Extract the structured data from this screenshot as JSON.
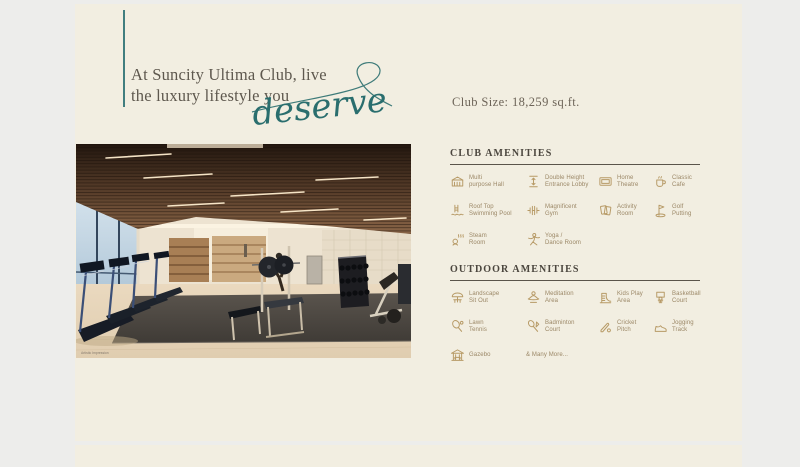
{
  "hero": {
    "line1": "At Suncity Ultima Club, live",
    "line2": "the luxury lifestyle you",
    "script": "deserve"
  },
  "club_size": {
    "label": "Club Size: 18,259 sq.ft."
  },
  "photo": {
    "caption": "Artistic Impression"
  },
  "club_amenities": {
    "title": "CLUB AMENITIES",
    "items": [
      {
        "icon": "hall-icon",
        "label": "Multi purpose Hall",
        "lines": [
          "Multi",
          "purpose Hall"
        ]
      },
      {
        "icon": "lobby-icon",
        "label": "Double Height Entrance Lobby",
        "lines": [
          "Double Height",
          "Entrance Lobby"
        ]
      },
      {
        "icon": "theatre-icon",
        "label": "Home Theatre",
        "lines": [
          "Home",
          "Theatre"
        ]
      },
      {
        "icon": "cafe-icon",
        "label": "Classic Cafe",
        "lines": [
          "Classic",
          "Cafe"
        ]
      },
      {
        "icon": "pool-icon",
        "label": "Roof Top Swimming Pool",
        "lines": [
          "Roof Top",
          "Swimming Pool"
        ]
      },
      {
        "icon": "gym-icon",
        "label": "Magnificent Gym",
        "lines": [
          "Magnificent",
          "Gym"
        ]
      },
      {
        "icon": "activity-icon",
        "label": "Activity Room",
        "lines": [
          "Activity",
          "Room"
        ]
      },
      {
        "icon": "golf-icon",
        "label": "Golf Putting",
        "lines": [
          "Golf",
          "Putting"
        ]
      },
      {
        "icon": "steam-icon",
        "label": "Steam Room",
        "lines": [
          "Steam",
          "Room"
        ]
      },
      {
        "icon": "yoga-icon",
        "label": "Yoga / Dance Room",
        "lines": [
          "Yoga /",
          "Dance Room"
        ]
      }
    ]
  },
  "outdoor_amenities": {
    "title": "OUTDOOR AMENITIES",
    "items": [
      {
        "icon": "landscape-icon",
        "label": "Landscape Sit Out",
        "lines": [
          "Landscape",
          "Sit Out"
        ]
      },
      {
        "icon": "meditation-icon",
        "label": "Meditation Area",
        "lines": [
          "Meditation",
          "Area"
        ]
      },
      {
        "icon": "kids-play-icon",
        "label": "Kids Play Area",
        "lines": [
          "Kids Play",
          "Area"
        ]
      },
      {
        "icon": "basketball-icon",
        "label": "Basketball Court",
        "lines": [
          "Basketball",
          "Court"
        ]
      },
      {
        "icon": "lawn-tennis-icon",
        "label": "Lawn Tennis",
        "lines": [
          "Lawn",
          "Tennis"
        ]
      },
      {
        "icon": "badminton-icon",
        "label": "Badminton Court",
        "lines": [
          "Badminton",
          "Court"
        ]
      },
      {
        "icon": "cricket-icon",
        "label": "Cricket Pitch",
        "lines": [
          "Cricket",
          "Pitch"
        ]
      },
      {
        "icon": "jogging-icon",
        "label": "Jogging Track",
        "lines": [
          "Jogging",
          "Track"
        ]
      },
      {
        "icon": "gazebo-icon",
        "label": "Gazebo",
        "lines": [
          "Gazebo"
        ]
      },
      {
        "icon": null,
        "label": "& Many More...",
        "lines": [
          "& Many More..."
        ]
      }
    ]
  },
  "colors": {
    "accent_teal": "#2f7071",
    "gold": "#b79a66",
    "cream": "#f2eee1",
    "page_bg": "#ededeb",
    "title_ink": "#4b463e"
  }
}
